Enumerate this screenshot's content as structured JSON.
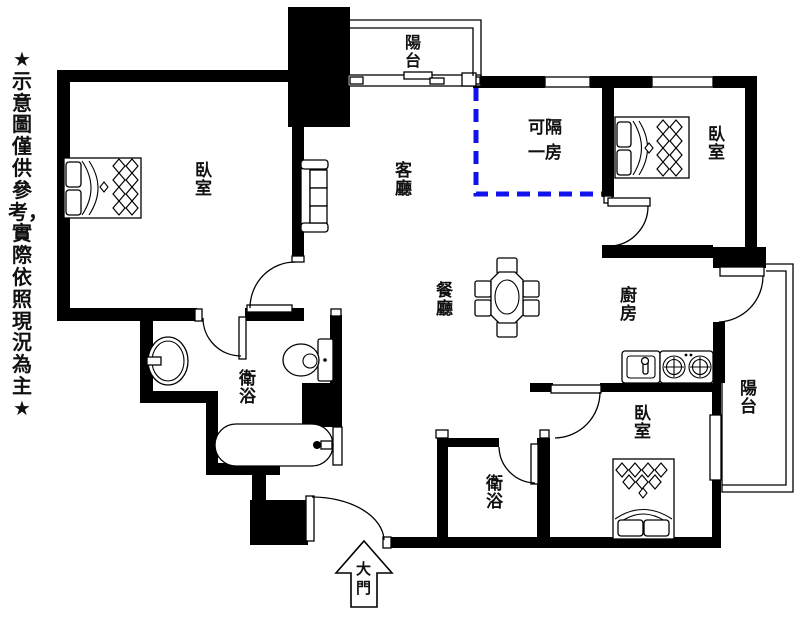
{
  "disclaimer": "★示意圖僅供參考，實際依照現況為主★",
  "rooms": {
    "balcony_top": "陽台",
    "partition_suggestion": "可隔一房",
    "living_room": "客廳",
    "bedroom_master": "臥室",
    "bedroom_top_right": "臥室",
    "bedroom_bottom": "臥室",
    "dining_room": "餐廳",
    "kitchen": "廚房",
    "bathroom_main": "衛浴",
    "bathroom_guest": "衛浴",
    "balcony_right": "陽台",
    "main_entrance": "大門"
  },
  "legend": {
    "wall_color": "#000000",
    "partition_dashed_color": "#1212ee",
    "background": "#ffffff"
  },
  "icons": [
    "double-bed-icon",
    "sofa-icon",
    "dining-table-icon",
    "toilet-icon",
    "washbasin-icon",
    "bathtub-icon",
    "kitchen-sink-icon",
    "stove-icon",
    "entrance-arrow-icon",
    "door-swing-icon",
    "window-icon"
  ]
}
